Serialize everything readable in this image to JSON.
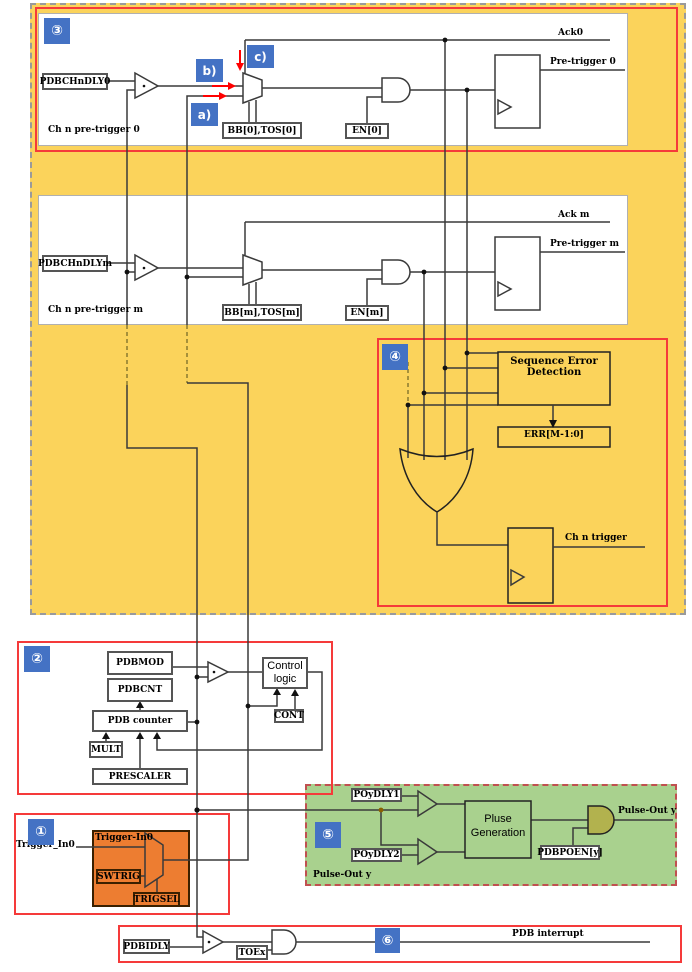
{
  "colors": {
    "region_yellow": "#FBD35B",
    "box_red": "#F53A3A",
    "badge_blue": "#4472C4",
    "orange_fill": "#ED7D31",
    "green_fill": "#A9D18E",
    "and_olive": "#B2B24E",
    "arrow_red": "#FF0000",
    "line_dark": "#3a3a3a"
  },
  "section3": {
    "badge": "③",
    "callout_a": "a)",
    "callout_b": "b)",
    "callout_c": "c)",
    "delay_reg": "PDBCHnDLY0",
    "channel_label": "Ch n pre-trigger 0",
    "bb_tos": "BB[0],TOS[0]",
    "en": "EN[0]",
    "ack": "Ack0",
    "pre_trigger": "Pre-trigger 0"
  },
  "channel_m": {
    "delay_reg": "PDBCHnDLYm",
    "channel_label": "Ch n pre-trigger m",
    "bb_tos": "BB[m],TOS[m]",
    "en": "EN[m]",
    "ack": "Ack m",
    "pre_trigger": "Pre-trigger m"
  },
  "section4": {
    "badge": "④",
    "sed_line1": "Sequence Error",
    "sed_line2": "Detection",
    "err": "ERR[M-1:0]",
    "ch_trigger": "Ch n trigger"
  },
  "section2": {
    "badge": "②",
    "pdbmod": "PDBMOD",
    "pdbcnt": "PDBCNT",
    "counter": "PDB counter",
    "mult": "MULT",
    "prescaler": "PRESCALER",
    "cont": "CONT",
    "control_line1": "Control",
    "control_line2": "logic"
  },
  "section1": {
    "badge": "①",
    "external_trigger": "Trigger_In0",
    "trigger_in": "Trigger-In0",
    "swtrig": "SWTRIG",
    "trigsel": "TRIGSEL"
  },
  "section5": {
    "badge": "⑤",
    "poydly1": "POyDLY1",
    "poydly2": "POyDLY2",
    "pulse_gen_line1": "Pluse",
    "pulse_gen_line2": "Generation",
    "poen": "PDBPOEN[y]",
    "pulse_out": "Pulse-Out y",
    "pulse_out_bottom": "Pulse-Out y"
  },
  "section6": {
    "badge": "⑥",
    "pdbidly": "PDBIDLY",
    "toex": "TOEx",
    "interrupt": "PDB interrupt"
  }
}
